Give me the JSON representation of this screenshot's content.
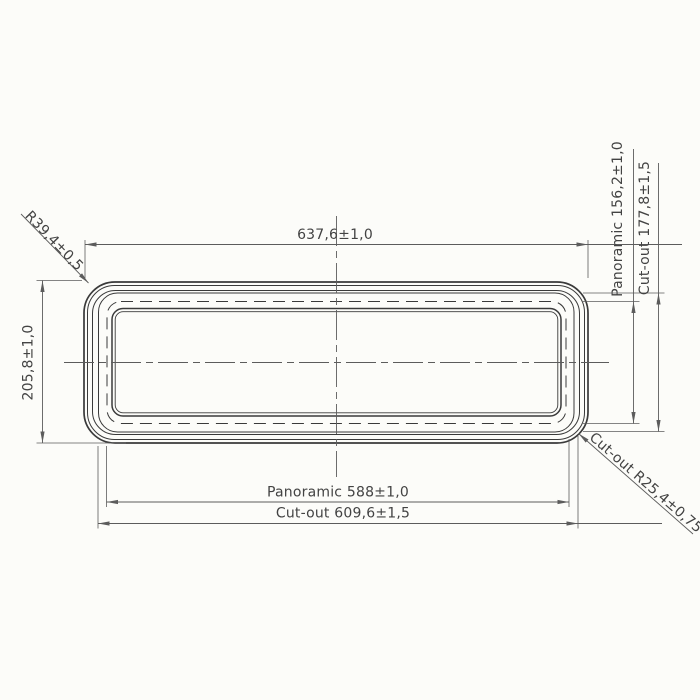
{
  "colors": {
    "background": "#fcfcf9",
    "outline": "#3a3a3a",
    "dimension": "#5c5c5c",
    "text": "#434343"
  },
  "labels": {
    "overall_width": "637,6±1,0",
    "overall_height": "205,8±1,0",
    "corner_radius": "R39,4±0,5",
    "panoramic_height": "Panoramic 156,2±1,0",
    "cutout_height": "Cut-out 177,8±1,5",
    "panoramic_width": "Panoramic 588±1,0",
    "cutout_width": "Cut-out 609,6±1,5",
    "cutout_radius": "Cut-out R25,4±0,75"
  }
}
